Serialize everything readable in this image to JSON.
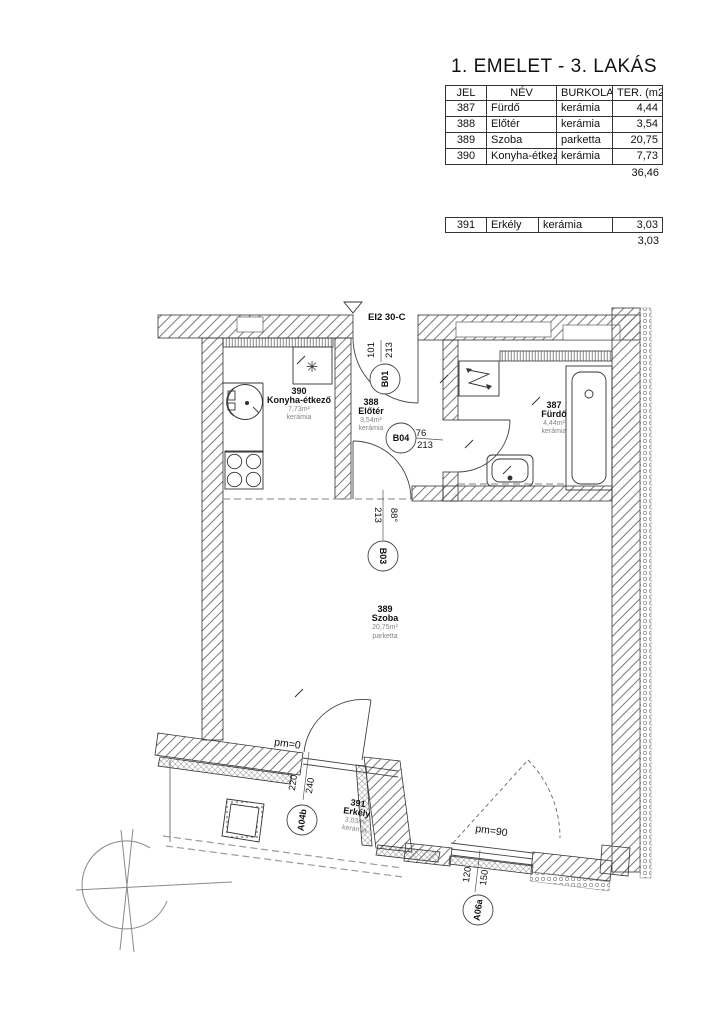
{
  "header": {
    "title": "1. EMELET - 3. LAKÁS"
  },
  "area_table": {
    "headers": {
      "jel": "JEL",
      "nev": "NÉV",
      "burkolat": "BURKOLAT",
      "ter": "TER. (m2)"
    },
    "rows": [
      {
        "jel": "387",
        "nev": "Fürdő",
        "burkolat": "kerámia",
        "ter": "4,44"
      },
      {
        "jel": "388",
        "nev": "Előtér",
        "burkolat": "kerámia",
        "ter": "3,54"
      },
      {
        "jel": "389",
        "nev": "Szoba",
        "burkolat": "parketta",
        "ter": "20,75"
      },
      {
        "jel": "390",
        "nev": "Konyha-étkező",
        "burkolat": "kerámia",
        "ter": "7,73"
      }
    ],
    "total": "36,46"
  },
  "balcony_table": {
    "row": {
      "jel": "391",
      "nev": "Erkély",
      "burkolat": "kerámia",
      "ter": "3,03"
    },
    "total": "3,03"
  },
  "plan": {
    "entrance_label": "EI2 30-C",
    "fridge_symbol": "✳",
    "rooms": {
      "konyha": {
        "number": "390",
        "name": "Konyha-étkező",
        "area": "7,73m²",
        "floor": "kerámia"
      },
      "eloter": {
        "number": "388",
        "name": "Előtér",
        "area": "3,54m²",
        "floor": "kerámia"
      },
      "furdo": {
        "number": "387",
        "name": "Fürdő",
        "area": "4,44m²",
        "floor": "kerámia"
      },
      "szoba": {
        "number": "389",
        "name": "Szoba",
        "area": "20,75m²",
        "floor": "parketta"
      },
      "erkely": {
        "number": "391",
        "name": "Erkély",
        "area": "3,03m²",
        "floor": "kerámia"
      }
    },
    "markers": {
      "b01": {
        "id": "B01",
        "dim_left": "101",
        "dim_right": "213"
      },
      "b03": {
        "id": "B03",
        "dim_left": "213",
        "dim_right": "88°"
      },
      "b04": {
        "id": "B04",
        "dim_top": "76",
        "dim_bottom": "213"
      },
      "a04b": {
        "id": "A04b",
        "dim_left": "220",
        "dim_right": "240",
        "pm": "pm=0"
      },
      "a06a": {
        "id": "A06a",
        "dim_left": "120",
        "dim_right": "150",
        "pm": "pm=90"
      }
    }
  }
}
